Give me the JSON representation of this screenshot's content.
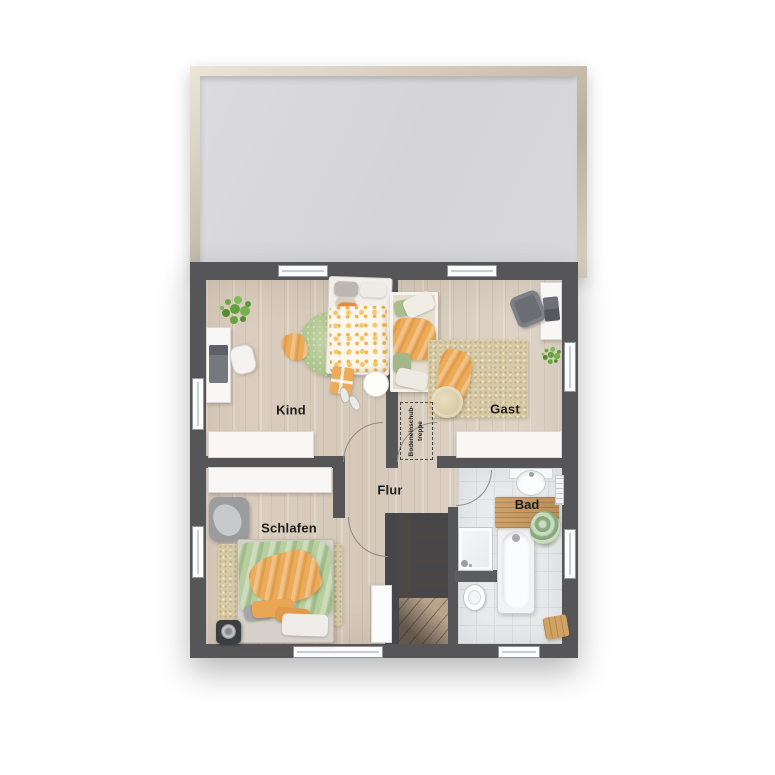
{
  "rooms": {
    "kind": {
      "label": "Kind"
    },
    "gast": {
      "label": "Gast"
    },
    "flur": {
      "label": "Flur"
    },
    "schlafen": {
      "label": "Schlafen"
    },
    "bad": {
      "label": "Bad"
    }
  },
  "attic": {
    "line1": "Bodeneinschub-",
    "line2": "treppe"
  },
  "colors": {
    "wall": "#565659",
    "floor_wood": "#d9cec1",
    "floor_tile": "#eaebed",
    "roof_panel": "#d8d8db",
    "roof_frame": "#cfc6b5",
    "rug_green": "#aec68c",
    "rug_beige": "#d7caa4",
    "bedding_orange": "#ecab59",
    "bedding_green": "#b7cf9f",
    "furniture_white": "#f8f7f5",
    "label_text": "#1d1d1d"
  }
}
